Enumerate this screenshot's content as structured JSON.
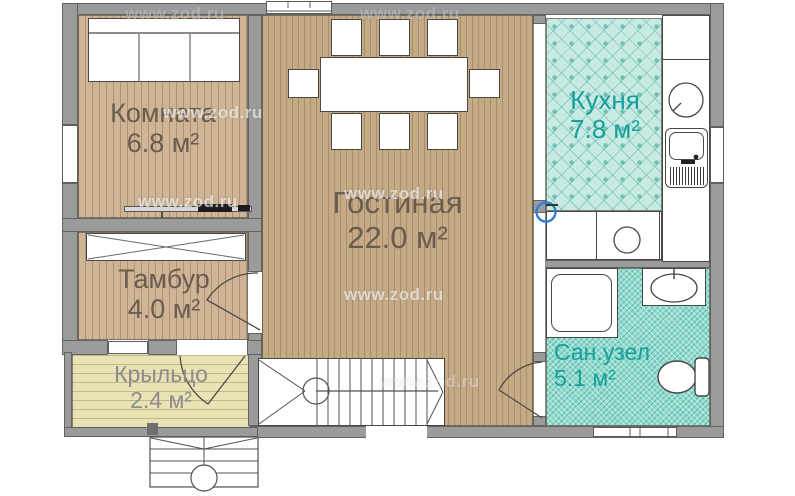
{
  "watermark": "www.zod.ru",
  "rooms": {
    "komnata": {
      "name": "Комната",
      "area": "6.8 м²"
    },
    "gostinaya": {
      "name": "Гостиная",
      "area": "22.0 м²"
    },
    "kuhnya": {
      "name": "Кухня",
      "area": "7.8 м²"
    },
    "tambur": {
      "name": "Тамбур",
      "area": "4.0 м²"
    },
    "kryltso": {
      "name": "Крыльцо",
      "area": "2.4 м²"
    },
    "sanuzel": {
      "name": "Сан.узел",
      "area": "5.1 м²"
    }
  },
  "colors": {
    "wall": "#9b9b9b",
    "wood_light": "#cfb596",
    "wood_main": "#c5aa86",
    "porch": "#e9e2b4",
    "kitchen_tile": "#c7ebe2",
    "bath_tile": "#93dbce",
    "label_brown": "#6b5c50",
    "label_teal": "#17a09b",
    "label_gray": "#8d8d8d",
    "marker_blue": "#2f7fd6"
  }
}
